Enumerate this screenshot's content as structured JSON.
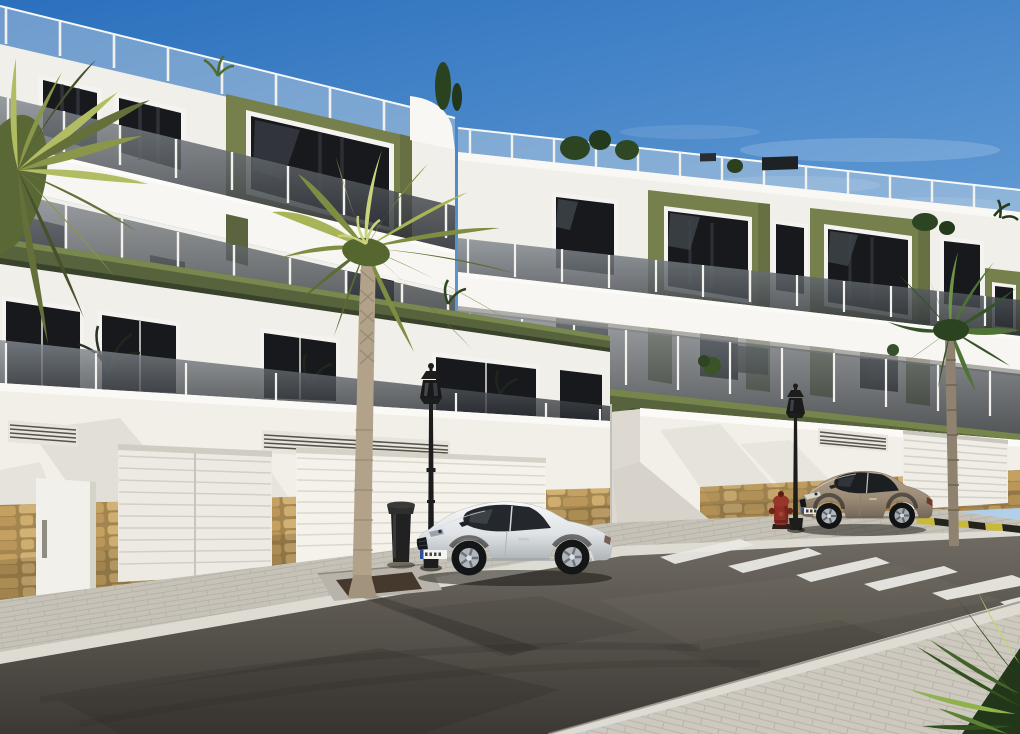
{
  "colors": {
    "sky_top": "#2b70bd",
    "sky_mid": "#5d97d2",
    "sky_horizon": "#c3dbf0",
    "cloud": "#ffffff",
    "facade_white": "#f1efe9",
    "facade_bright": "#f7f6f2",
    "accent_olive": "#76804d",
    "band_olive": "#57633c",
    "pergola_green": "#39442a",
    "window_glass": "#17191c",
    "window_frame": "#f4f3ef",
    "balustrade_post": "#f2f1ed",
    "roof_glass": "#ccd8e2",
    "glass_top": "#878d93",
    "glass_bottom": "#262a2e",
    "wall_white": "#f1efe8",
    "stone_tan": "#c9a568",
    "stone_grout": "#a3854f",
    "sidewalk": "#c6c2b8",
    "paver_near": "#cdc9bf",
    "curb_white": "#dedbd3",
    "road_light": "#6f6a62",
    "road_dark": "#3c3934",
    "crosswalk_white": "#eae8e2",
    "curb_yellow": "#c9b93b",
    "curb_black": "#24241f",
    "car_white": "#f7f8f8",
    "car_white_shade": "#aeb4b8",
    "car_beige": "#b5a590",
    "car_beige_shade": "#73655a",
    "car_glass": "#24282c",
    "rim_silver": "#b0b6bc",
    "palm_light": "#a8b457",
    "palm_mid": "#7e8d42",
    "palm_dark": "#5c6c33",
    "palm_deep": "#35542a",
    "trunk": "#b2a28a",
    "lamp_black": "#1d1d1d",
    "hydrant_red": "#8e2e25",
    "shrub_dark": "#2c4421",
    "soil": "#44392c"
  },
  "scene": {
    "type": "architectural-exterior-render",
    "time_of_day": "sunny daytime, clear blue sky",
    "objects": [
      "left-apartment-building-3-floors-white-and-olive-green",
      "right-apartment-building-white-and-olive-green",
      "background-building-far-right",
      "roof-terrace-glass-balustrades",
      "balcony-tinted-glass-railings-with-white-posts",
      "olive-green-balcony-bands-with-pergola-slats",
      "garage-door-narrow-left",
      "garage-door-wide-left",
      "garage-door-right",
      "ventilation-grilles",
      "natural-stone-wall-base",
      "paved-sidewalk-far",
      "paved-sidewalk-near-corner",
      "asphalt-road",
      "pedestrian-crosswalk-white-stripes",
      "yellow-black-painted-curb",
      "white-coupe-car-parked",
      "beige-coupe-car-parked",
      "classic-street-lamp-left",
      "classic-street-lamp-right",
      "litter-bin",
      "red-fire-hydrant",
      "palm-tree-center",
      "palm-tree-left-corner",
      "palm-tree-right",
      "palm-fronds-bottom-right",
      "balcony-plants",
      "rooftop-shrubs",
      "tree-pit-concrete-ring"
    ],
    "counts": {
      "cars": 2,
      "street_lamps": 2,
      "palm_trees": 4,
      "garage_doors": 3
    }
  }
}
